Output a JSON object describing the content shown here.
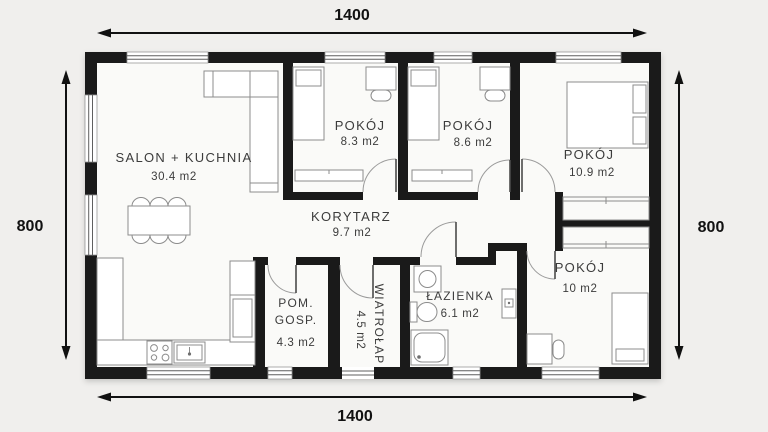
{
  "plan": {
    "rooms": {
      "salon": {
        "name": "SALON + KUCHNIA",
        "area": "30.4 m2"
      },
      "pokoj_83": {
        "name": "POKÓJ",
        "area": "8.3 m2"
      },
      "pokoj_86": {
        "name": "POKÓJ",
        "area": "8.6 m2"
      },
      "pokoj_109": {
        "name": "POKÓJ",
        "area": "10.9 m2"
      },
      "korytarz": {
        "name": "KORYTARZ",
        "area": "9.7 m2"
      },
      "pom_gosp": {
        "name_line1": "POM.",
        "name_line2": "GOSP.",
        "area": "4.3 m2"
      },
      "wiatrolap": {
        "name": "WIATROŁAP",
        "area": "4.5 m2"
      },
      "lazienka": {
        "name": "ŁAZIENKA",
        "area": "6.1 m2"
      },
      "pokoj_10": {
        "name": "POKÓJ",
        "area": "10 m2"
      }
    },
    "dimensions": {
      "width_top": "1400",
      "width_bottom": "1400",
      "height_left": "800",
      "height_right": "800"
    },
    "colors": {
      "wall": "#1a1a1a",
      "background": "#f0efed",
      "floor": "#fafaf8",
      "furniture_stroke": "#8c8c8c",
      "label_text": "#3c3c3c"
    }
  }
}
